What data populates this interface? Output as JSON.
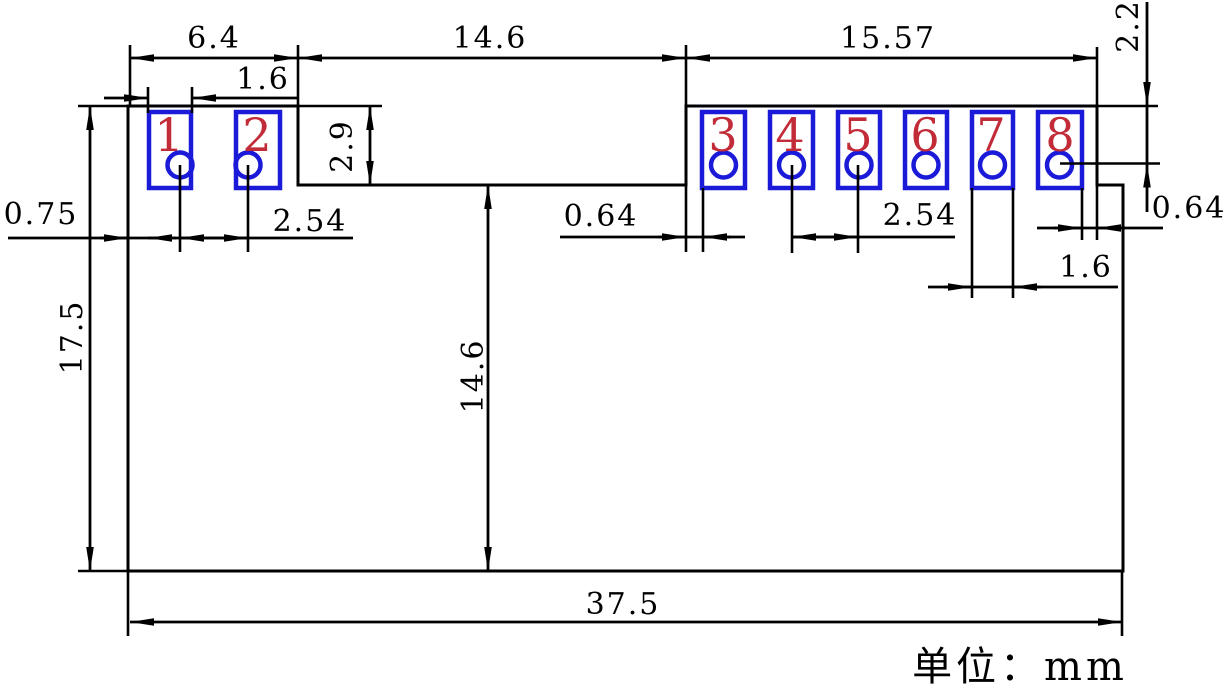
{
  "drawing": {
    "unit_note": "单位：mm",
    "colors": {
      "line": "#000000",
      "pad_outline": "#1a1ad8",
      "pad_number": "#c22b38"
    },
    "pads": [
      {
        "number": "1"
      },
      {
        "number": "2"
      },
      {
        "number": "3"
      },
      {
        "number": "4"
      },
      {
        "number": "5"
      },
      {
        "number": "6"
      },
      {
        "number": "7"
      },
      {
        "number": "8"
      }
    ],
    "dims": {
      "left_block_width": "6.4",
      "pad1_width": "1.6",
      "middle_notch_width": "14.6",
      "right_block_width": "15.57",
      "top_edge_to_hole8": "2.2",
      "notch_depth": "2.9",
      "left_edge_to_pad1": "0.75",
      "hole_pitch_left": "2.54",
      "right_block_edge_to_pad3": "0.64",
      "hole_pitch_right": "2.54",
      "pad8_to_right_edge": "0.64",
      "pad7_width": "1.6",
      "overall_height": "17.5",
      "body_height_below_notch": "14.6",
      "overall_width": "37.5"
    }
  }
}
